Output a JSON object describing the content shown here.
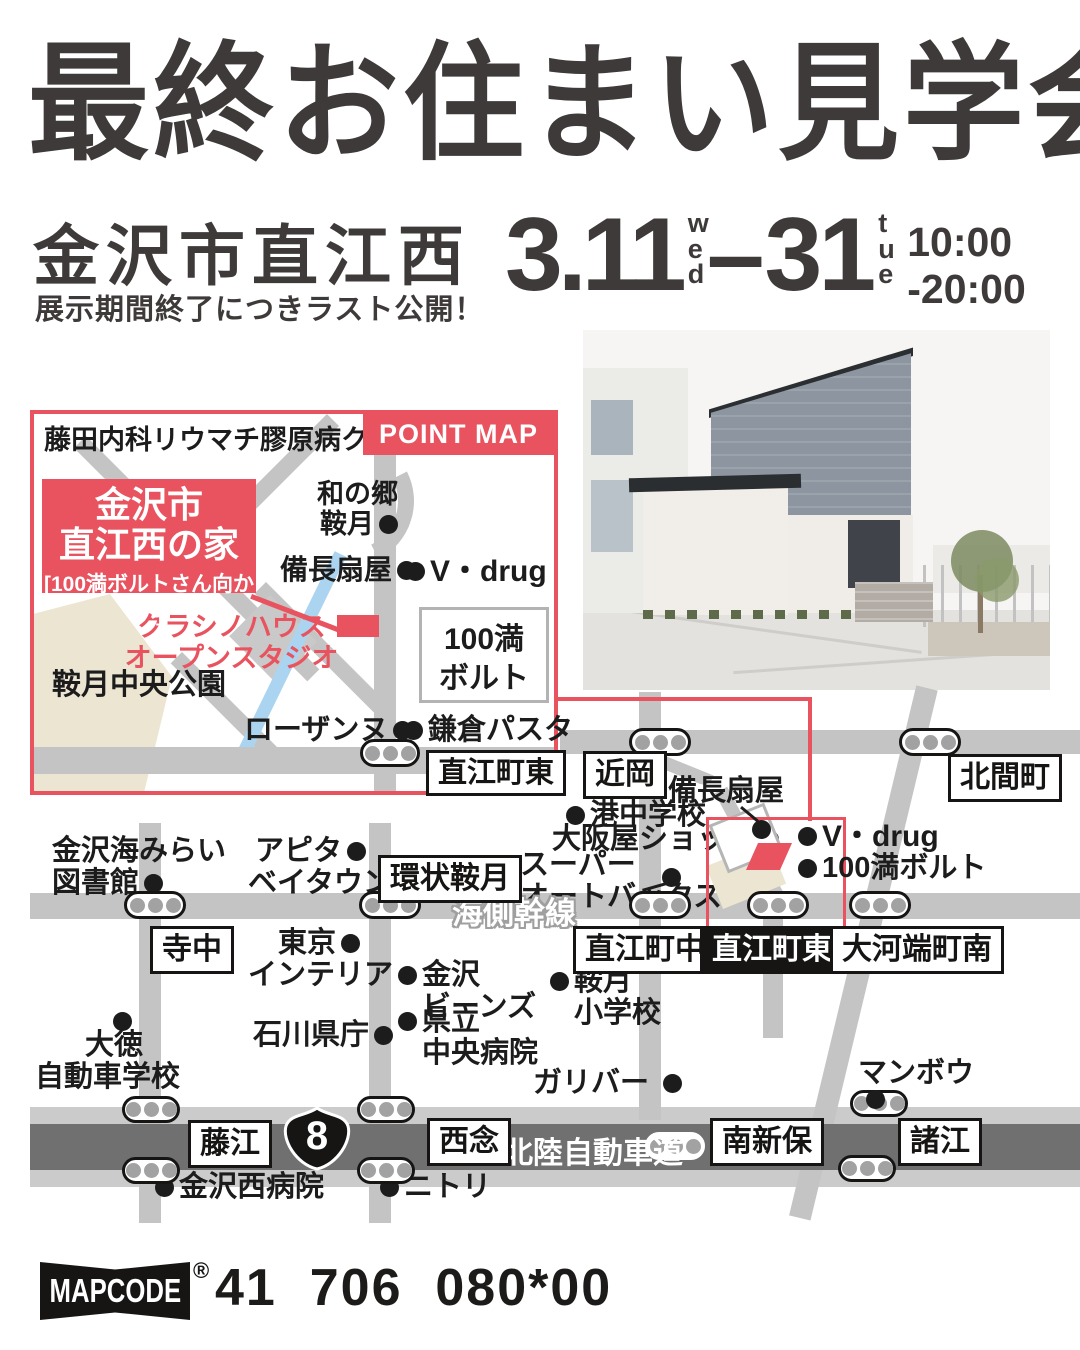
{
  "colors": {
    "red": "#e8535f",
    "ink": "#3e3a39",
    "road": "#c4c4c4",
    "road_dark": "#707070",
    "beige": "#ece5d2",
    "stream": "#abd4f0"
  },
  "header": {
    "title": "最終お住まい見学会",
    "location": "金沢市直江西",
    "tagline": "展示期間終了につきラスト公開！",
    "date_start": "3.11",
    "date_start_dow": "wed",
    "date_dash": "–",
    "date_end": "31",
    "date_end_dow": "tue",
    "hours_line1": "10:00",
    "hours_line2": "-20:00"
  },
  "point_map": {
    "badge": "POINT MAP",
    "clinic": "藤田内科リウマチ膠原病クリニック",
    "venue_line1": "金沢市",
    "venue_line2": "直江西の家",
    "venue_note": "[100満ボルトさん向かい]",
    "wanosato_l1": "和の郷",
    "wanosato_l2": "鞍月",
    "bincho": "備長扇屋",
    "vdrug": "V・drug",
    "kurashino_l1": "クラシノハウス",
    "kurashino_l2": "オープンスタジオ",
    "park": "鞍月中央公園",
    "hyakuman_l1": "100満",
    "hyakuman_l2": "ボルト",
    "lausanne": "ローザンヌ",
    "kamakura": "鎌倉パスタ",
    "naoe_higashi": "直江町東"
  },
  "map": {
    "boxes": {
      "chikaoka": "近岡",
      "kitamamachi": "北間町",
      "kanjo_kuratsuki": "環状鞍月",
      "terachu": "寺中",
      "naoe_naka": "直江町中",
      "naoe_higashi": "直江町東",
      "okawabata": "大河端町南",
      "fujie": "藤江",
      "sainen": "西念",
      "minami_shinbo": "南新保",
      "moroe": "諸江"
    },
    "pois": {
      "library_l1": "金沢海みらい",
      "library_l2": "図書館",
      "apita_l1": "アピタ",
      "apita_l2": "ベイタウン",
      "tokyo_l1": "東京",
      "tokyo_l2": "インテリア",
      "beans_l1": "金沢",
      "beans_l2": "ビーンズ",
      "kenritsu_l1": "県立",
      "kenritsu_l2": "中央病院",
      "kencho": "石川県庁",
      "kuratsuki_l1": "鞍月",
      "kuratsuki_l2": "小学校",
      "daitoku_l1": "大徳",
      "daitoku_l2": "自動車学校",
      "minato": "港中学校",
      "osakaya": "大阪屋ショップ",
      "autobacs_l1": "スーパー",
      "autobacs_l2": "オートバックス",
      "bincho": "備長扇屋",
      "vdrug": "V・drug",
      "hyakuman": "100満ボルト",
      "gulliver": "ガリバー",
      "manbo": "マンボウ",
      "nishi_hospital": "金沢西病院",
      "nitori": "ニトリ"
    },
    "road_labels": {
      "kaisoku": "海側幹線",
      "hokuriku_expwy": "北陸自動車道"
    },
    "route_number": "8"
  },
  "footer": {
    "logo": "MAPCODE",
    "registered": "®",
    "code": "41  706  080*00"
  }
}
